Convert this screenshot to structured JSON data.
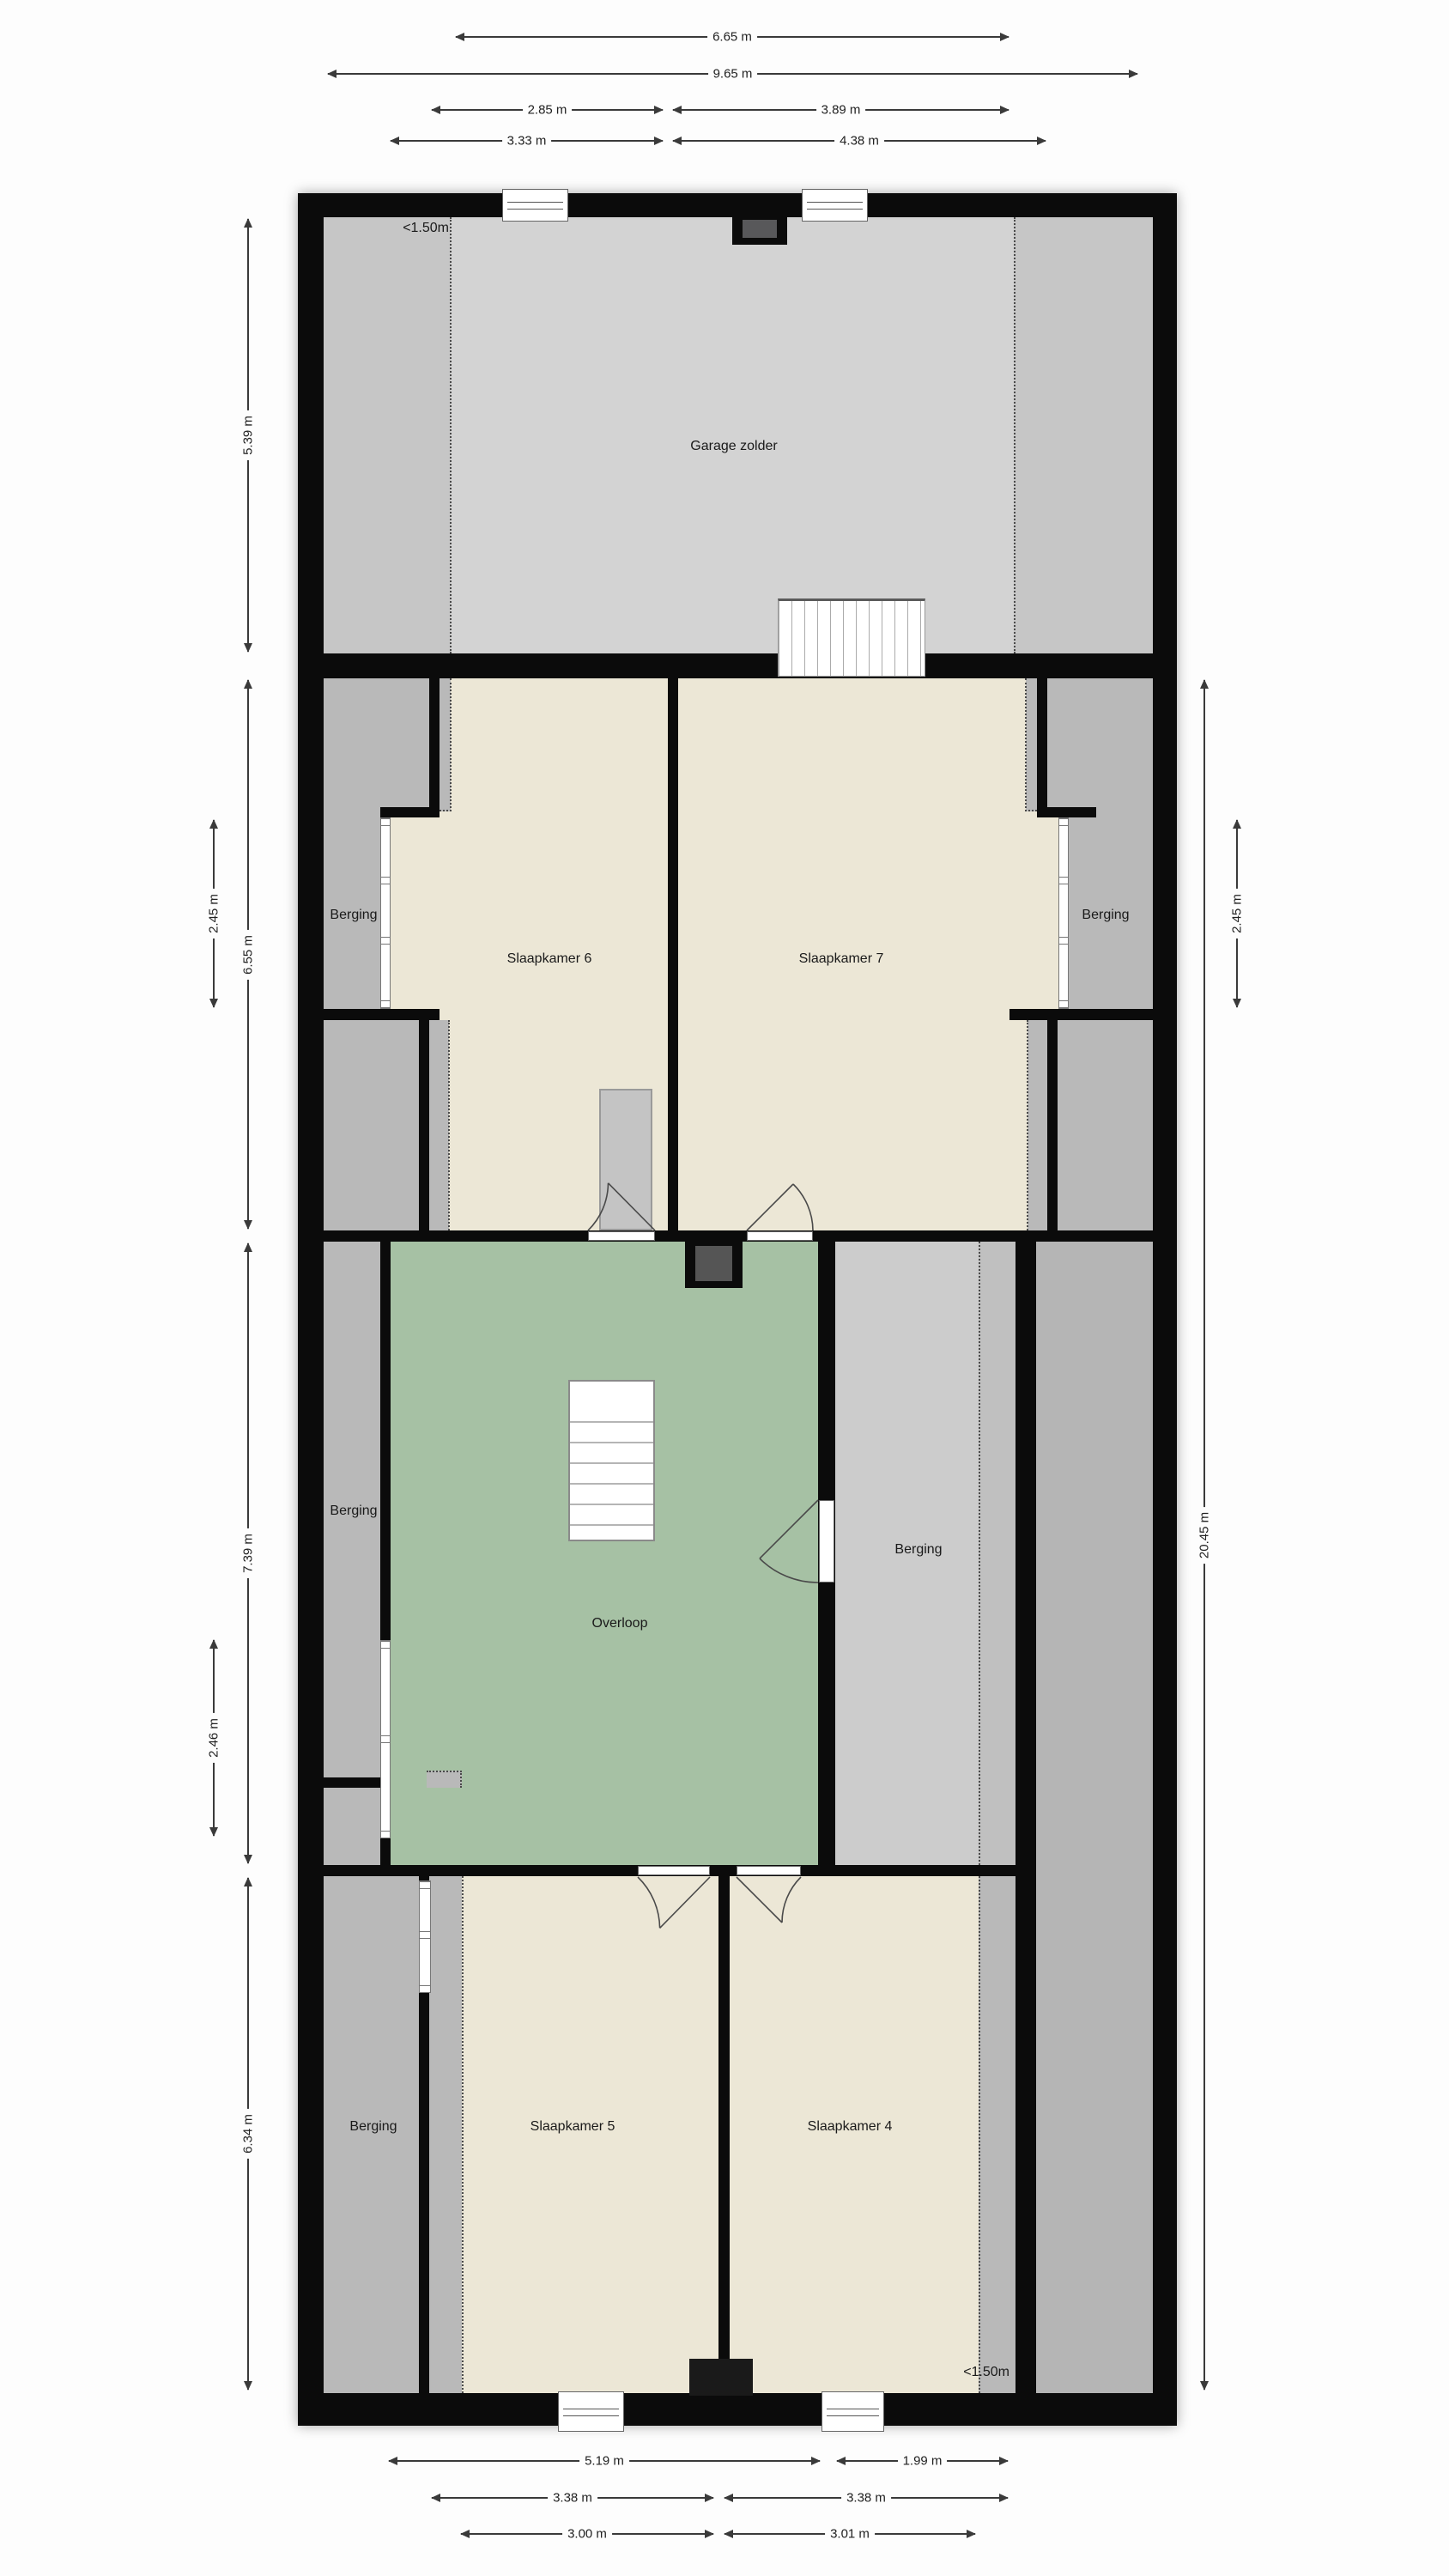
{
  "plan_title": "Floor plan - attic storey",
  "rooms": [
    {
      "id": "garage-zolder",
      "label": "Garage zolder"
    },
    {
      "id": "slaapkamer-6",
      "label": "Slaapkamer 6"
    },
    {
      "id": "slaapkamer-7",
      "label": "Slaapkamer 7"
    },
    {
      "id": "berging-bed-left",
      "label": "Berging"
    },
    {
      "id": "berging-bed-right",
      "label": "Berging"
    },
    {
      "id": "berging-mid-left",
      "label": "Berging"
    },
    {
      "id": "overloop",
      "label": "Overloop"
    },
    {
      "id": "berging-mid-right",
      "label": "Berging"
    },
    {
      "id": "berging-bottom-left",
      "label": "Berging"
    },
    {
      "id": "slaapkamer-5",
      "label": "Slaapkamer 5"
    },
    {
      "id": "slaapkamer-4",
      "label": "Slaapkamer 4"
    }
  ],
  "headroom": [
    {
      "id": "headroom-top",
      "text": "<1.50m"
    },
    {
      "id": "headroom-bottom",
      "text": "<1.50m"
    }
  ],
  "dims": [
    {
      "label": "6.65 m"
    },
    {
      "label": "9.65 m"
    },
    {
      "label": "2.85 m"
    },
    {
      "label": "3.89 m"
    },
    {
      "label": "3.33 m"
    },
    {
      "label": "4.38 m"
    },
    {
      "label": "5.39 m"
    },
    {
      "label": "6.55 m"
    },
    {
      "label": "2.45 m"
    },
    {
      "label": "7.39 m"
    },
    {
      "label": "2.46 m"
    },
    {
      "label": "6.34 m"
    },
    {
      "label": "20.45 m"
    },
    {
      "label": "2.45 m"
    },
    {
      "label": "5.19 m"
    },
    {
      "label": "1.99 m"
    },
    {
      "label": "3.38 m"
    },
    {
      "label": "3.38 m"
    },
    {
      "label": "3.00 m"
    },
    {
      "label": "3.01 m"
    }
  ],
  "colors": {
    "wall": "#0b0b0b",
    "bedroom_floor": "#ece7d6",
    "hall_floor": "#a6c1a4",
    "storage_gray": "#b9b9b9",
    "garage_gray": "#d3d3d3",
    "garage_low_gray": "#c6c6c6",
    "light_storage_gray": "#cccccc",
    "chimney_inner": "#58585a"
  }
}
